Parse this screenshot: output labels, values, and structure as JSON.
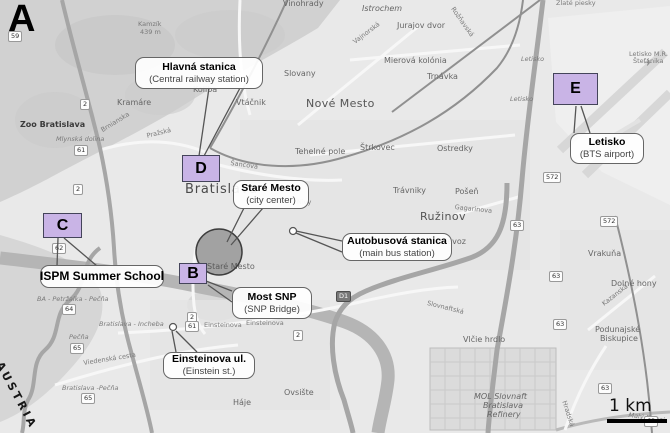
{
  "panel": {
    "label": "A"
  },
  "colors": {
    "marker_fill": "#c9b4e6",
    "marker_border": "#44445a",
    "callout_bg": "#ffffff",
    "callout_border": "#666666",
    "city_center_circle": "#4b4b4b",
    "map_base": "#e9e9e9"
  },
  "icons": {
    "airplane": "✈"
  },
  "scale_bar": {
    "label": "1 km"
  },
  "markers": [
    {
      "letter": "B",
      "x": 179,
      "y": 263,
      "w": 28,
      "h": 21
    },
    {
      "letter": "C",
      "x": 43,
      "y": 213,
      "w": 39,
      "h": 25
    },
    {
      "letter": "D",
      "x": 182,
      "y": 155,
      "w": 38,
      "h": 27
    },
    {
      "letter": "E",
      "x": 553,
      "y": 73,
      "w": 45,
      "h": 32
    }
  ],
  "callouts": [
    {
      "id": "hlavna-stanica",
      "title": "Hlavná stanica",
      "subtitle": "(Central railway station)",
      "x": 135,
      "y": 57,
      "w": 128,
      "h": 32
    },
    {
      "id": "stare-mesto",
      "title": "Staré Mesto",
      "subtitle": "(city center)",
      "x": 233,
      "y": 180,
      "w": 76,
      "h": 29
    },
    {
      "id": "autobusova-stanica",
      "title": "Autobusová stanica",
      "subtitle": "(main bus station)",
      "x": 342,
      "y": 233,
      "w": 110,
      "h": 28
    },
    {
      "id": "most-snp",
      "title": "Most SNP",
      "subtitle": "(SNP Bridge)",
      "x": 232,
      "y": 287,
      "w": 80,
      "h": 32
    },
    {
      "id": "einsteinova",
      "title": "Einsteinova ul.",
      "subtitle": "(Einstein st.)",
      "x": 163,
      "y": 352,
      "w": 92,
      "h": 27
    },
    {
      "id": "ispm-summer-school",
      "title": "ISPM Summer School",
      "subtitle": "",
      "x": 40,
      "y": 265,
      "w": 124,
      "h": 23,
      "c": "big"
    },
    {
      "id": "letisko",
      "title": "Letisko",
      "subtitle": "(BTS airport)",
      "x": 570,
      "y": 133,
      "w": 74,
      "h": 31
    }
  ],
  "map_labels": [
    {
      "t": "Vinohrady",
      "x": 283,
      "y": 0,
      "c": "sm"
    },
    {
      "t": "Istrochem",
      "x": 362,
      "y": 5,
      "c": "sm i"
    },
    {
      "t": "Jurajov dvor",
      "x": 397,
      "y": 22,
      "c": "sm"
    },
    {
      "t": "Zlaté piesky",
      "x": 556,
      "y": 0,
      "c": "xs"
    },
    {
      "t": "Kamzík",
      "x": 138,
      "y": 21,
      "c": "xs"
    },
    {
      "t": "439 m",
      "x": 140,
      "y": 29,
      "c": "xs"
    },
    {
      "t": "Mierová kolónia",
      "x": 384,
      "y": 57,
      "c": "sm"
    },
    {
      "t": "Slovany",
      "x": 284,
      "y": 70,
      "c": "sm"
    },
    {
      "t": "Trnávka",
      "x": 427,
      "y": 73,
      "c": "sm"
    },
    {
      "t": "Koliba",
      "x": 193,
      "y": 86,
      "c": "sm"
    },
    {
      "t": "Vtáčnik",
      "x": 236,
      "y": 99,
      "c": "sm"
    },
    {
      "t": "Kramáre",
      "x": 117,
      "y": 99,
      "c": "sm"
    },
    {
      "t": "Nové Mesto",
      "x": 306,
      "y": 98,
      "c": "town"
    },
    {
      "t": "Letisko M.R.",
      "x": 629,
      "y": 51,
      "c": "xs"
    },
    {
      "t": "Štefánika",
      "x": 633,
      "y": 58,
      "c": "xs"
    },
    {
      "t": "Letisko",
      "x": 521,
      "y": 56,
      "c": "xs i"
    },
    {
      "t": "Letisko",
      "x": 510,
      "y": 96,
      "c": "xs i"
    },
    {
      "t": "Zoo Bratislava",
      "x": 20,
      "y": 121,
      "c": "sm b"
    },
    {
      "t": "Mlynská dolina",
      "x": 56,
      "y": 136,
      "c": "xs i"
    },
    {
      "t": "Brnianska",
      "x": 100,
      "y": 128,
      "c": "xs",
      "rot": -32
    },
    {
      "t": "Pražská",
      "x": 146,
      "y": 133,
      "c": "xs",
      "rot": -14
    },
    {
      "t": "Tehelné pole",
      "x": 295,
      "y": 148,
      "c": "sm"
    },
    {
      "t": "Štrkovec",
      "x": 360,
      "y": 144,
      "c": "sm"
    },
    {
      "t": "Ostredky",
      "x": 437,
      "y": 145,
      "c": "sm"
    },
    {
      "t": "Šancová",
      "x": 231,
      "y": 160,
      "c": "xs",
      "rot": 8
    },
    {
      "t": "Bratislava",
      "x": 185,
      "y": 183,
      "c": "city"
    },
    {
      "t": "Trávniky",
      "x": 393,
      "y": 187,
      "c": "sm"
    },
    {
      "t": "Pošeň",
      "x": 455,
      "y": 188,
      "c": "sm"
    },
    {
      "t": "Gagarinova",
      "x": 455,
      "y": 204,
      "c": "xs",
      "rot": 6
    },
    {
      "t": "Nivy",
      "x": 297,
      "y": 199,
      "c": "xs"
    },
    {
      "t": "Ružinov",
      "x": 420,
      "y": 211,
      "c": "town"
    },
    {
      "t": "Prievoz",
      "x": 437,
      "y": 238,
      "c": "sm"
    },
    {
      "t": "Vrakuňa",
      "x": 588,
      "y": 250,
      "c": "sm"
    },
    {
      "t": "Staré Mesto",
      "x": 207,
      "y": 263,
      "c": "sm"
    },
    {
      "t": "Dolné hony",
      "x": 611,
      "y": 280,
      "c": "sm"
    },
    {
      "t": "BA - Petržalka - Pečňa",
      "x": 37,
      "y": 296,
      "c": "xs i"
    },
    {
      "t": "Kazanská",
      "x": 601,
      "y": 302,
      "c": "xs",
      "rot": -38
    },
    {
      "t": "Slovnaftská",
      "x": 428,
      "y": 300,
      "c": "xs",
      "rot": 14
    },
    {
      "t": "Bratislava - Incheba",
      "x": 99,
      "y": 321,
      "c": "xs i"
    },
    {
      "t": "Einsteinova",
      "x": 204,
      "y": 322,
      "c": "xs"
    },
    {
      "t": "Einsteinova",
      "x": 246,
      "y": 320,
      "c": "xs"
    },
    {
      "t": "Podunajské",
      "x": 595,
      "y": 326,
      "c": "sm"
    },
    {
      "t": "Biskupice",
      "x": 600,
      "y": 335,
      "c": "sm"
    },
    {
      "t": "Pečňa",
      "x": 69,
      "y": 334,
      "c": "xs i"
    },
    {
      "t": "Vlčie hrdlo",
      "x": 463,
      "y": 336,
      "c": "sm"
    },
    {
      "t": "Viedenská cesta",
      "x": 83,
      "y": 360,
      "c": "xs",
      "rot": -9
    },
    {
      "t": "AUSTRIA",
      "x": 4,
      "y": 360,
      "c": "austria",
      "rot": 62
    },
    {
      "t": "Bratislava -Pečňa",
      "x": 62,
      "y": 385,
      "c": "xs i"
    },
    {
      "t": "Ovsište",
      "x": 284,
      "y": 389,
      "c": "sm"
    },
    {
      "t": "MOL Slovnaft",
      "x": 474,
      "y": 393,
      "c": "sm i"
    },
    {
      "t": "Háje",
      "x": 233,
      "y": 399,
      "c": "sm"
    },
    {
      "t": "Bratislava",
      "x": 483,
      "y": 402,
      "c": "sm i"
    },
    {
      "t": "Hradská",
      "x": 567,
      "y": 400,
      "c": "xs",
      "rot": 72
    },
    {
      "t": "Refinery",
      "x": 487,
      "y": 411,
      "c": "sm i"
    },
    {
      "t": "Malý Dunaj",
      "x": 629,
      "y": 412,
      "c": "xs i",
      "rot": 8
    },
    {
      "t": "Vajnorská",
      "x": 352,
      "y": 40,
      "c": "xs",
      "rot": -37
    },
    {
      "t": "Rožňavská",
      "x": 455,
      "y": 6,
      "c": "xs",
      "rot": 55
    }
  ],
  "road_badges": [
    {
      "t": "59",
      "x": 8,
      "y": 31
    },
    {
      "t": "2",
      "x": 80,
      "y": 99
    },
    {
      "t": "61",
      "x": 74,
      "y": 145
    },
    {
      "t": "2",
      "x": 73,
      "y": 184
    },
    {
      "t": "62",
      "x": 52,
      "y": 243
    },
    {
      "t": "64",
      "x": 62,
      "y": 304
    },
    {
      "t": "65",
      "x": 70,
      "y": 343
    },
    {
      "t": "65",
      "x": 81,
      "y": 393
    },
    {
      "t": "2",
      "x": 187,
      "y": 312
    },
    {
      "t": "61",
      "x": 185,
      "y": 321
    },
    {
      "t": "2",
      "x": 293,
      "y": 330
    },
    {
      "t": "D1",
      "x": 336,
      "y": 291,
      "dark": true
    },
    {
      "t": "63",
      "x": 510,
      "y": 220
    },
    {
      "t": "63",
      "x": 549,
      "y": 271
    },
    {
      "t": "63",
      "x": 553,
      "y": 319
    },
    {
      "t": "63",
      "x": 598,
      "y": 383
    },
    {
      "t": "63",
      "x": 644,
      "y": 416
    },
    {
      "t": "572",
      "x": 543,
      "y": 172
    },
    {
      "t": "572",
      "x": 600,
      "y": 216
    }
  ]
}
